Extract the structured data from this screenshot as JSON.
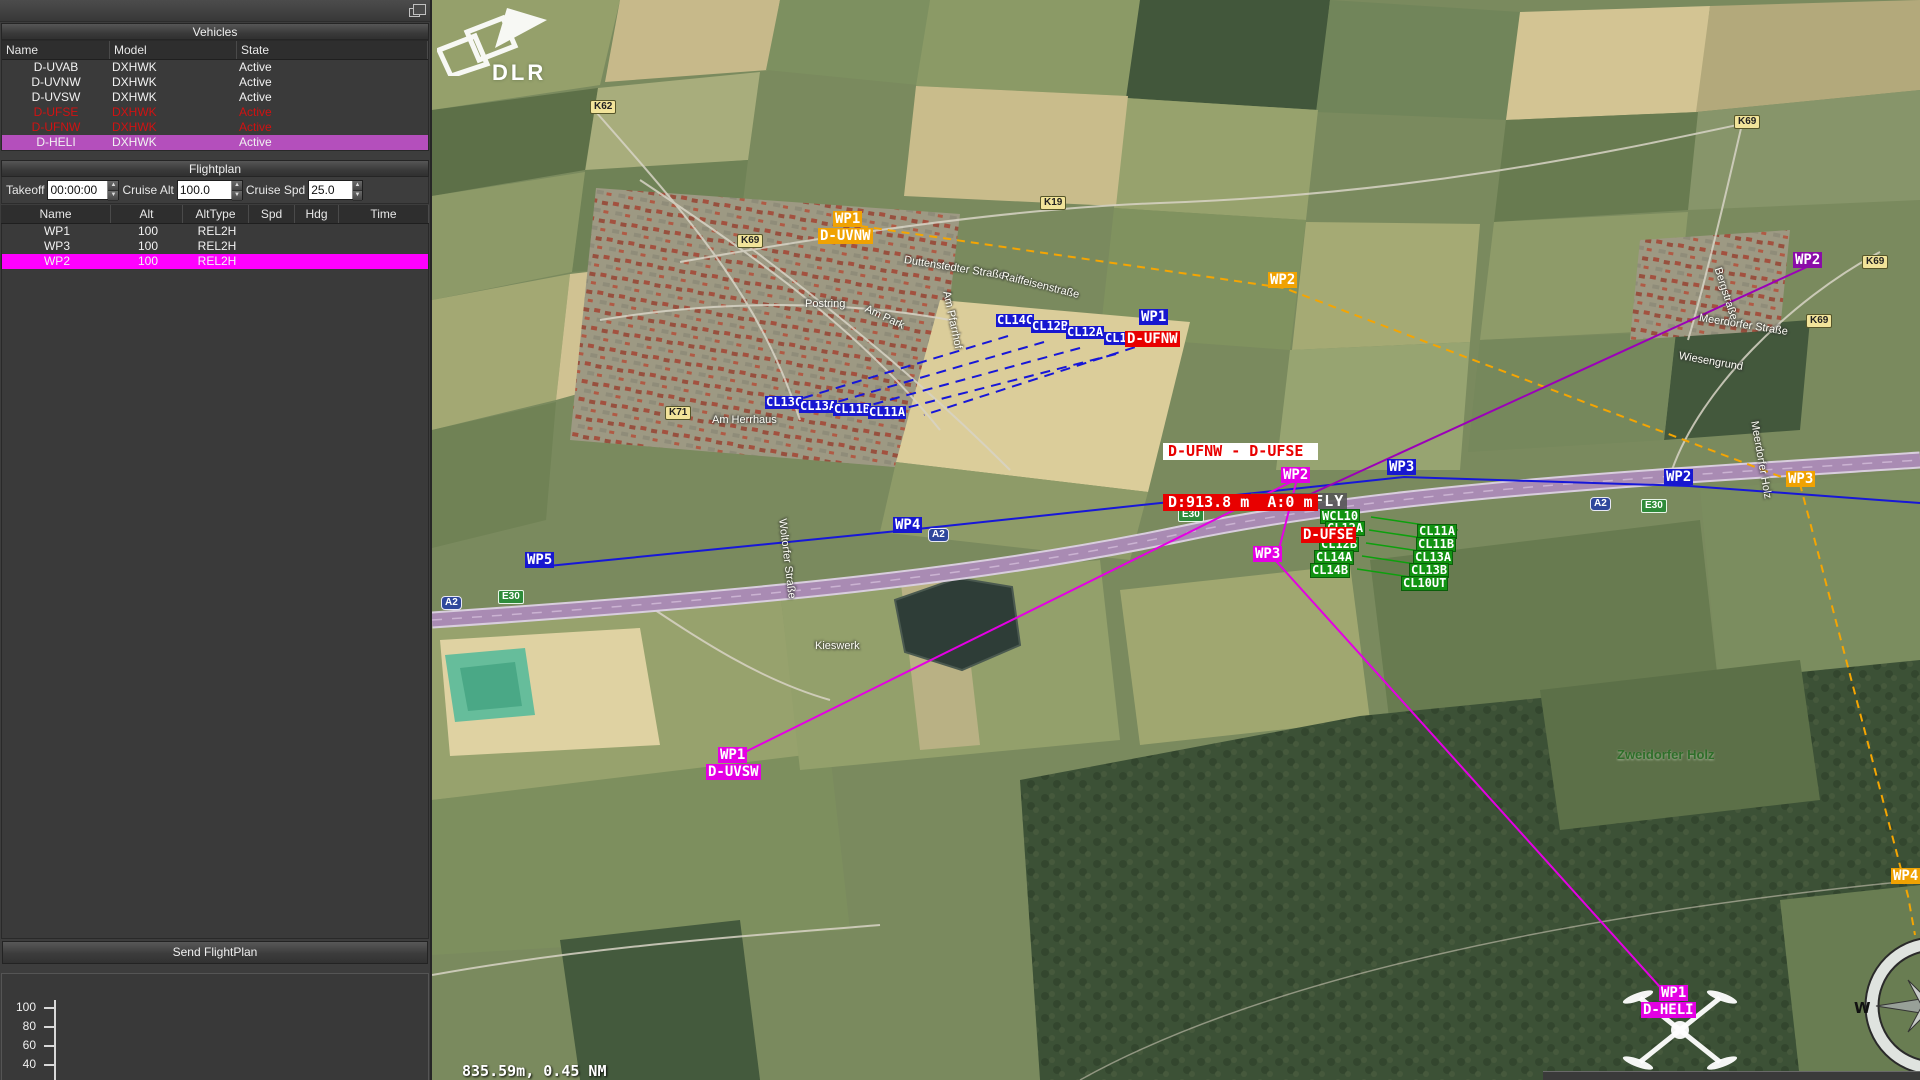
{
  "window": {
    "panel_title": "Vehicles"
  },
  "vehicles": {
    "title": "Vehicles",
    "columns": [
      "Name",
      "Model",
      "State"
    ],
    "rows": [
      {
        "name": "D-UVAB",
        "model": "DXHWK",
        "state": "Active",
        "status": "normal"
      },
      {
        "name": "D-UVNW",
        "model": "DXHWK",
        "state": "Active",
        "status": "normal"
      },
      {
        "name": "D-UVSW",
        "model": "DXHWK",
        "state": "Active",
        "status": "normal"
      },
      {
        "name": "D-UFSE",
        "model": "DXHWK",
        "state": "Active",
        "status": "alert"
      },
      {
        "name": "D-UFNW",
        "model": "DXHWK",
        "state": "Active",
        "status": "alert"
      },
      {
        "name": "D-HELI",
        "model": "DXHWK",
        "state": "Active",
        "status": "selected"
      }
    ]
  },
  "flightplan": {
    "title": "Flightplan",
    "takeoff_label": "Takeoff",
    "takeoff_value": "00:00:00",
    "cruise_alt_label": "Cruise Alt",
    "cruise_alt_value": "100.0",
    "cruise_spd_label": "Cruise Spd",
    "cruise_spd_value": "25.0",
    "columns": [
      "Name",
      "Alt",
      "AltType",
      "Spd",
      "Hdg",
      "Time"
    ],
    "rows": [
      {
        "name": "WP1",
        "alt": "100",
        "alttype": "REL2H",
        "spd": "",
        "hdg": "",
        "time": "",
        "selected": false
      },
      {
        "name": "WP3",
        "alt": "100",
        "alttype": "REL2H",
        "spd": "",
        "hdg": "",
        "time": "",
        "selected": false
      },
      {
        "name": "WP2",
        "alt": "100",
        "alttype": "REL2H",
        "spd": "",
        "hdg": "",
        "time": "",
        "selected": true
      }
    ],
    "send_button": "Send FlightPlan"
  },
  "altitude_profile": {
    "ticks": [
      "100",
      "80",
      "60",
      "40"
    ]
  },
  "map": {
    "logo_text": "DLR",
    "scale_text": "835.59m, 0.45 NM",
    "compass_label": "W",
    "gcs_label": {
      "text": "GCS U-FLY",
      "x": 1251,
      "y": 493
    },
    "separation_warning": {
      "pair": "D-UFNW - D-UFSE",
      "distance": "D:913.8 m  A:0 m",
      "x": 1163,
      "y": 409
    },
    "colors": {
      "orange": "#f0a202",
      "blue": "#1717d0",
      "magenta": "#e400e4",
      "purple": "#8a0ca8",
      "red": "#e80000",
      "green": "#129312",
      "selected_row": "#b44fbc",
      "selected_wp": "#ff00ff",
      "alert_text": "#d11212"
    },
    "waypoint_labels": [
      {
        "text": "WP1",
        "x": 833,
        "y": 211,
        "color": "orange"
      },
      {
        "text": "D-UVNW",
        "x": 818,
        "y": 228,
        "color": "orange"
      },
      {
        "text": "WP2",
        "x": 1268,
        "y": 272,
        "color": "orange"
      },
      {
        "text": "WP3",
        "x": 1786,
        "y": 471,
        "color": "orange"
      },
      {
        "text": "WP4",
        "x": 1891,
        "y": 868,
        "color": "orange"
      },
      {
        "text": "WP1",
        "x": 1139,
        "y": 309,
        "color": "blue"
      },
      {
        "text": "WP2",
        "x": 1664,
        "y": 469,
        "color": "blue"
      },
      {
        "text": "WP3",
        "x": 1387,
        "y": 459,
        "color": "blue"
      },
      {
        "text": "WP4",
        "x": 893,
        "y": 517,
        "color": "blue"
      },
      {
        "text": "WP5",
        "x": 525,
        "y": 552,
        "color": "blue"
      },
      {
        "text": "D-UFNW",
        "x": 1125,
        "y": 331,
        "color": "red"
      },
      {
        "text": "D-UFSE",
        "x": 1301,
        "y": 527,
        "color": "red"
      },
      {
        "text": "WP2",
        "x": 1281,
        "y": 467,
        "color": "magenta"
      },
      {
        "text": "WP3",
        "x": 1253,
        "y": 546,
        "color": "magenta"
      },
      {
        "text": "WP1",
        "x": 1659,
        "y": 985,
        "color": "magenta"
      },
      {
        "text": "D-HELI",
        "x": 1641,
        "y": 1002,
        "color": "magenta"
      },
      {
        "text": "WP1",
        "x": 718,
        "y": 747,
        "color": "magenta"
      },
      {
        "text": "D-UVSW",
        "x": 706,
        "y": 764,
        "color": "magenta"
      },
      {
        "text": "WP2",
        "x": 1793,
        "y": 252,
        "color": "purple"
      }
    ],
    "cluster_labels": [
      {
        "text": "CL14C",
        "x": 996,
        "y": 314,
        "color": "blue"
      },
      {
        "text": "CL12B",
        "x": 1031,
        "y": 320,
        "color": "blue"
      },
      {
        "text": "CL12A",
        "x": 1066,
        "y": 326,
        "color": "blue"
      },
      {
        "text": "CL10",
        "x": 1104,
        "y": 332,
        "color": "blue"
      },
      {
        "text": "CL13C",
        "x": 765,
        "y": 396,
        "color": "blue"
      },
      {
        "text": "CL13A",
        "x": 799,
        "y": 400,
        "color": "blue"
      },
      {
        "text": "CL11B",
        "x": 833,
        "y": 403,
        "color": "blue"
      },
      {
        "text": "CL11A",
        "x": 868,
        "y": 406,
        "color": "blue"
      },
      {
        "text": "WCL10",
        "x": 1320,
        "y": 509,
        "color": "green"
      },
      {
        "text": "CL12A",
        "x": 1325,
        "y": 521,
        "color": "green"
      },
      {
        "text": "CL12B",
        "x": 1319,
        "y": 537,
        "color": "green"
      },
      {
        "text": "CL14A",
        "x": 1314,
        "y": 550,
        "color": "green"
      },
      {
        "text": "CL14B",
        "x": 1310,
        "y": 563,
        "color": "green"
      },
      {
        "text": "CL11A",
        "x": 1417,
        "y": 524,
        "color": "green"
      },
      {
        "text": "CL11B",
        "x": 1416,
        "y": 537,
        "color": "green"
      },
      {
        "text": "CL13A",
        "x": 1413,
        "y": 550,
        "color": "green"
      },
      {
        "text": "CL13B",
        "x": 1409,
        "y": 563,
        "color": "green"
      },
      {
        "text": "CL10UT",
        "x": 1401,
        "y": 576,
        "color": "green"
      }
    ],
    "road_badges": [
      {
        "text": "K62",
        "x": 590,
        "y": 100,
        "kind": "county"
      },
      {
        "text": "K69",
        "x": 737,
        "y": 234,
        "kind": "county"
      },
      {
        "text": "K19",
        "x": 1040,
        "y": 196,
        "kind": "county"
      },
      {
        "text": "K71",
        "x": 665,
        "y": 406,
        "kind": "county"
      },
      {
        "text": "K69",
        "x": 1734,
        "y": 115,
        "kind": "county"
      },
      {
        "text": "K69",
        "x": 1862,
        "y": 255,
        "kind": "county"
      },
      {
        "text": "K69",
        "x": 1806,
        "y": 314,
        "kind": "county"
      },
      {
        "text": "A2",
        "x": 441,
        "y": 596,
        "kind": "autobahn"
      },
      {
        "text": "A2",
        "x": 928,
        "y": 528,
        "kind": "autobahn"
      },
      {
        "text": "A2",
        "x": 1590,
        "y": 497,
        "kind": "autobahn"
      },
      {
        "text": "E30",
        "x": 498,
        "y": 590,
        "kind": "euro"
      },
      {
        "text": "E30",
        "x": 1178,
        "y": 508,
        "kind": "euro"
      },
      {
        "text": "E30",
        "x": 1641,
        "y": 499,
        "kind": "euro"
      }
    ],
    "street_labels": [
      {
        "text": "Duttenstedter Straße",
        "x": 905,
        "y": 254,
        "rot": 9
      },
      {
        "text": "Raiffeisenstraße",
        "x": 1003,
        "y": 270,
        "rot": 14
      },
      {
        "text": "Postring",
        "x": 805,
        "y": 298,
        "rot": 0
      },
      {
        "text": "Am Park",
        "x": 868,
        "y": 303,
        "rot": 25
      },
      {
        "text": "Am Pfarrhof",
        "x": 952,
        "y": 290,
        "rot": 78
      },
      {
        "text": "Am Herrhaus",
        "x": 712,
        "y": 414,
        "rot": 0
      },
      {
        "text": "Kieswerk",
        "x": 815,
        "y": 640,
        "rot": 0
      },
      {
        "text": "Woltorfer Straße",
        "x": 788,
        "y": 518,
        "rot": 83
      },
      {
        "text": "Meerdorfer Straße",
        "x": 1700,
        "y": 312,
        "rot": 9
      },
      {
        "text": "Wiesengrund",
        "x": 1680,
        "y": 350,
        "rot": 10
      },
      {
        "text": "Bergstraße",
        "x": 1723,
        "y": 266,
        "rot": 72
      },
      {
        "text": "Meerdorfer Holz",
        "x": 1760,
        "y": 420,
        "rot": 80
      }
    ],
    "area_labels": [
      {
        "text": "Zweidorfer Holz",
        "x": 1617,
        "y": 747
      }
    ],
    "flight_paths": [
      {
        "name": "route-orange",
        "color": "#f5a502",
        "width": 2,
        "dash": "8 6",
        "points": [
          [
            860,
            226
          ],
          [
            1284,
            288
          ],
          [
            1800,
            484
          ],
          [
            1908,
            896
          ],
          [
            1915,
            935
          ]
        ]
      },
      {
        "name": "route-blue",
        "color": "#1717d8",
        "width": 2,
        "dash": "",
        "points": [
          [
            548,
            566
          ],
          [
            908,
            530
          ],
          [
            1404,
            477
          ],
          [
            1689,
            486
          ],
          [
            1920,
            503
          ]
        ]
      },
      {
        "name": "route-magenta-1",
        "color": "#e400e4",
        "width": 2,
        "dash": "",
        "points": [
          [
            741,
            754
          ],
          [
            1297,
            479
          ]
        ]
      },
      {
        "name": "route-magenta-2",
        "color": "#e400e4",
        "width": 2,
        "dash": "",
        "points": [
          [
            1297,
            479
          ],
          [
            1276,
            561
          ],
          [
            1669,
            997
          ]
        ]
      },
      {
        "name": "route-purple",
        "color": "#9b00b8",
        "width": 2,
        "dash": "",
        "points": [
          [
            1302,
            498
          ],
          [
            1809,
            266
          ]
        ]
      },
      {
        "name": "survey-blue-1",
        "color": "#1717d8",
        "width": 2,
        "dash": "10 7",
        "points": [
          [
            1008,
            336
          ],
          [
            790,
            402
          ]
        ]
      },
      {
        "name": "survey-blue-2",
        "color": "#1717d8",
        "width": 2,
        "dash": "10 7",
        "points": [
          [
            1044,
            342
          ],
          [
            823,
            406
          ]
        ]
      },
      {
        "name": "survey-blue-3",
        "color": "#1717d8",
        "width": 2,
        "dash": "10 7",
        "points": [
          [
            1080,
            348
          ],
          [
            856,
            409
          ]
        ]
      },
      {
        "name": "survey-blue-4",
        "color": "#1717d8",
        "width": 2,
        "dash": "10 7",
        "points": [
          [
            1116,
            354
          ],
          [
            890,
            412
          ]
        ]
      },
      {
        "name": "survey-blue-5",
        "color": "#1717d8",
        "width": 2,
        "dash": "10 7",
        "points": [
          [
            1151,
            342
          ],
          [
            924,
            415
          ]
        ]
      },
      {
        "name": "survey-green-1",
        "color": "#0da00d",
        "width": 1.5,
        "dash": "",
        "points": [
          [
            1371,
            517
          ],
          [
            1458,
            530
          ]
        ]
      },
      {
        "name": "survey-green-2",
        "color": "#0da00d",
        "width": 1.5,
        "dash": "",
        "points": [
          [
            1369,
            530
          ],
          [
            1456,
            543
          ]
        ]
      },
      {
        "name": "survey-green-3",
        "color": "#0da00d",
        "width": 1.5,
        "dash": "",
        "points": [
          [
            1366,
            543
          ],
          [
            1453,
            556
          ]
        ]
      },
      {
        "name": "survey-green-4",
        "color": "#0da00d",
        "width": 1.5,
        "dash": "",
        "points": [
          [
            1362,
            556
          ],
          [
            1449,
            569
          ]
        ]
      },
      {
        "name": "survey-green-5",
        "color": "#0da00d",
        "width": 1.5,
        "dash": "",
        "points": [
          [
            1357,
            569
          ],
          [
            1444,
            582
          ]
        ]
      }
    ]
  }
}
